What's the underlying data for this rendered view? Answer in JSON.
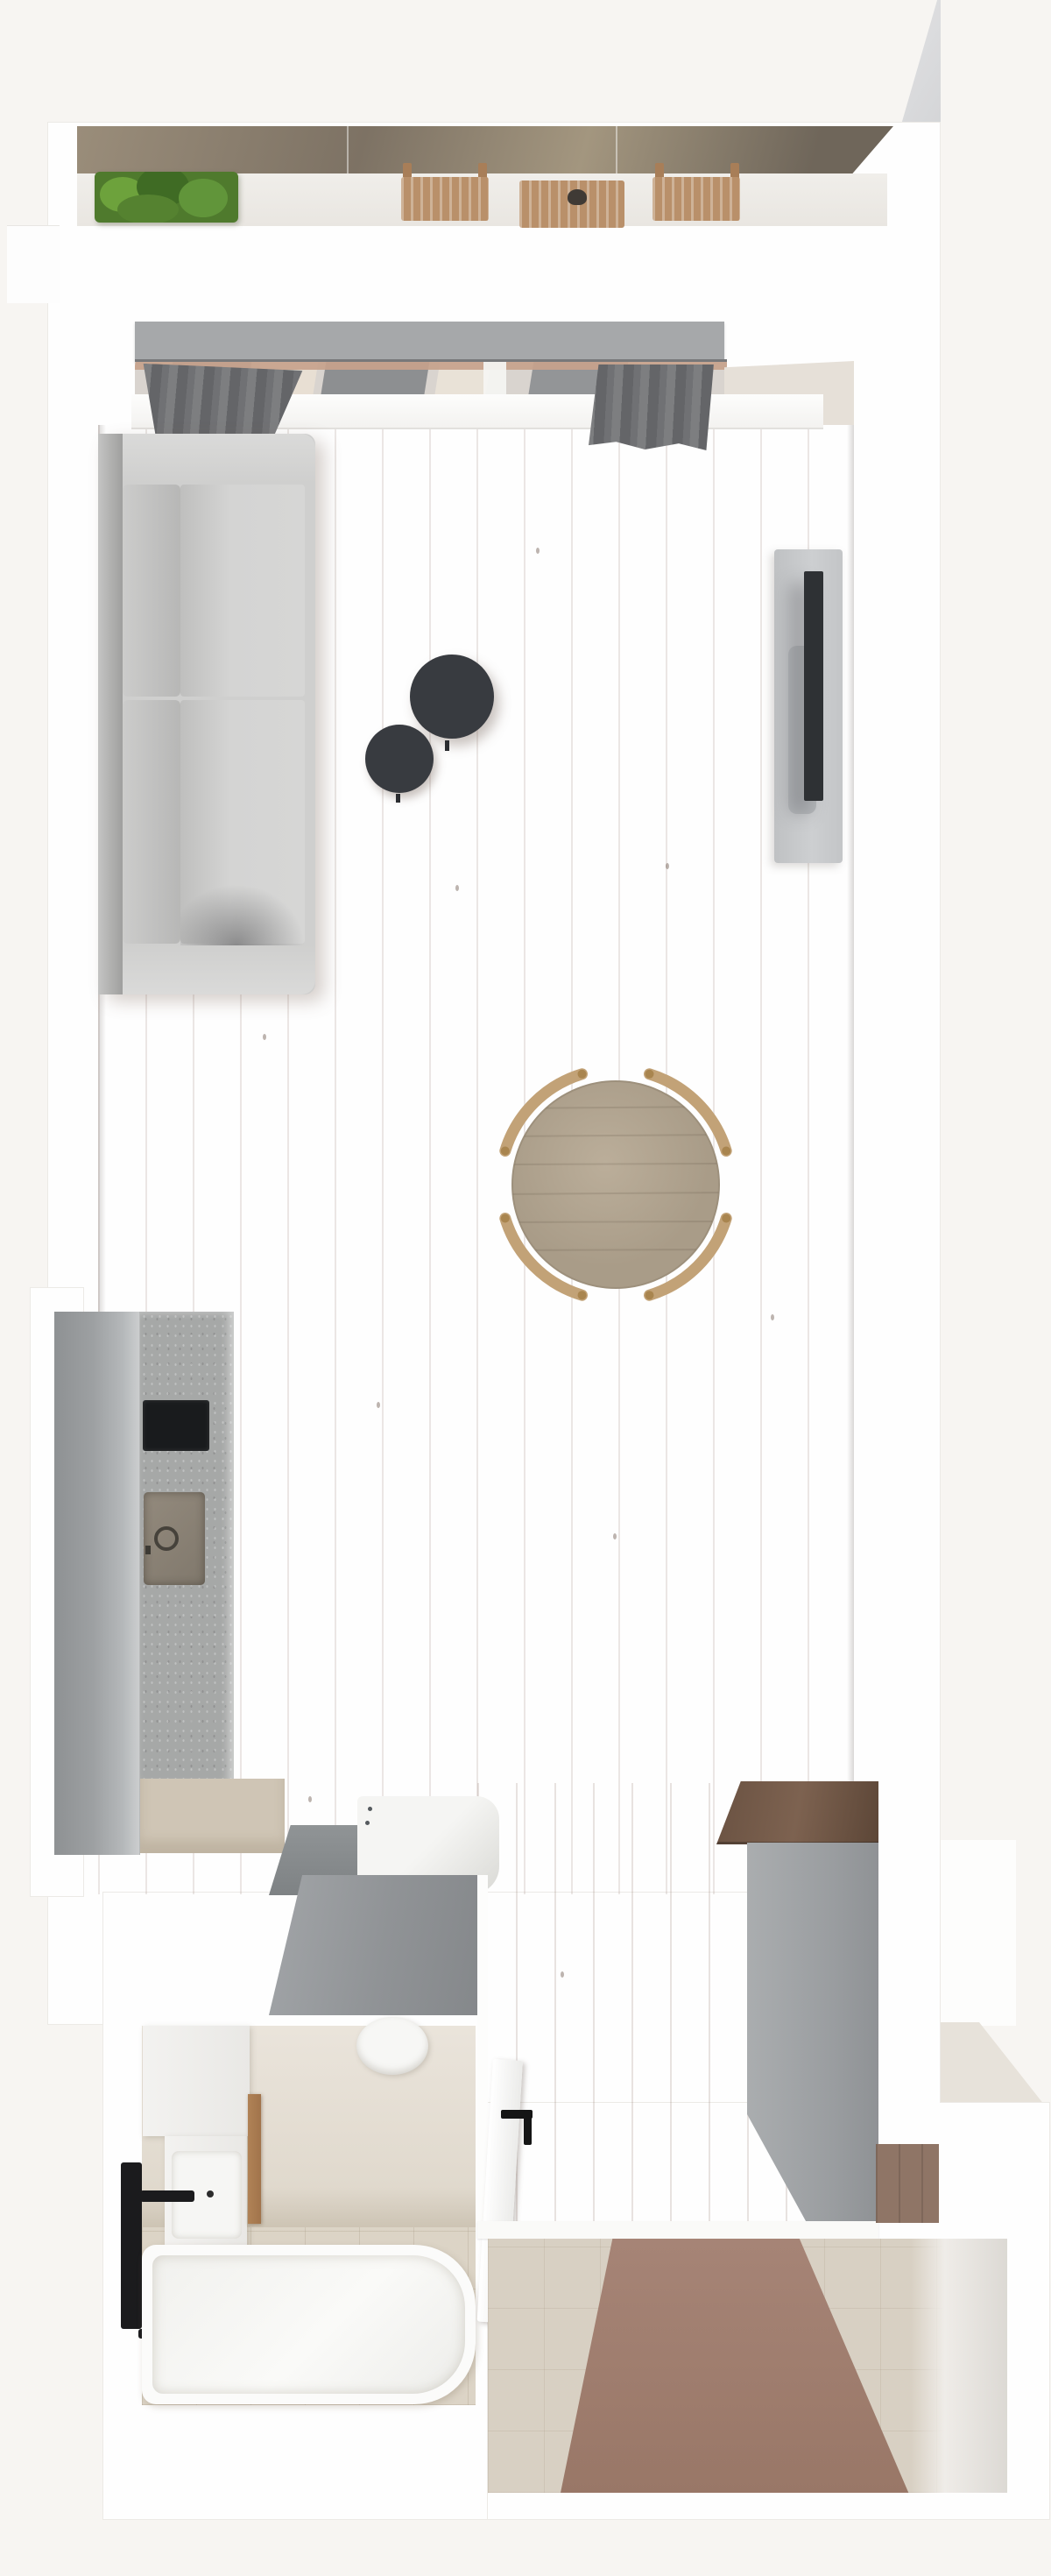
{
  "meta": {
    "title": "Top-down 3D render of a studio apartment floor plan",
    "view": "bird's-eye interior render",
    "visible_text": "none"
  },
  "labels": {
    "balcony": "balcony with planter, two wooden chairs and slatted table",
    "living": "living area with gray sofa, two round dark coffee tables and TV cabinet",
    "dining": "round wooden dining table with four curved-back chairs",
    "kitchen": "single-wall kitchen: tall gray cabinet, stone counter with cooktop and sink, beige corner counter, base cabinet and washing machine",
    "bathroom": "bathroom with vanity, basin, black towel radiator, wooden door, toilet and bathtub",
    "hall": "hallway with white bathroom door, gray-front wardrobe and entry threshold",
    "vestibule": "entry vestibule with beige tile and wood strip flooring",
    "window": "balcony window wall with gray pelmet and two gray curtains"
  },
  "palette": {
    "background": "#f7f5f2",
    "wall_white": "#fefefe",
    "exterior_beige": "#e7e2da",
    "railing_bronze": "#8a7e6c",
    "plant_green": "#4f7a2d",
    "patio_wood": "#b9906a",
    "pelmet_gray": "#a6a8aa",
    "curtain_gray": "#6e6f71",
    "floor_wood_light": "#e3cfc5",
    "floor_wood_dark": "#a18070",
    "sofa_gray": "#cfcfce",
    "coffee_table_dark": "#383b40",
    "tv_screen": "#2e3134",
    "tv_cabinet": "#c7c9cb",
    "dining_table_wood": "#b2a591",
    "chair_wood": "#c2a277",
    "kitchen_cabinet": "#9b9ea0",
    "counter_stone": "#a6a8a7",
    "cooktop_black": "#191b1d",
    "counter_beige": "#cfc5b5",
    "washer_white": "#f2f2f0",
    "bath_tile": "#dcd4c6",
    "tub_white": "#fbfbfa",
    "black_fixture": "#1b1b1d",
    "wood_door": "#ad8157",
    "wardrobe_wood_top": "#6a5242",
    "wardrobe_front_gray": "#9da0a3",
    "threshold_white": "#fafaf8"
  }
}
